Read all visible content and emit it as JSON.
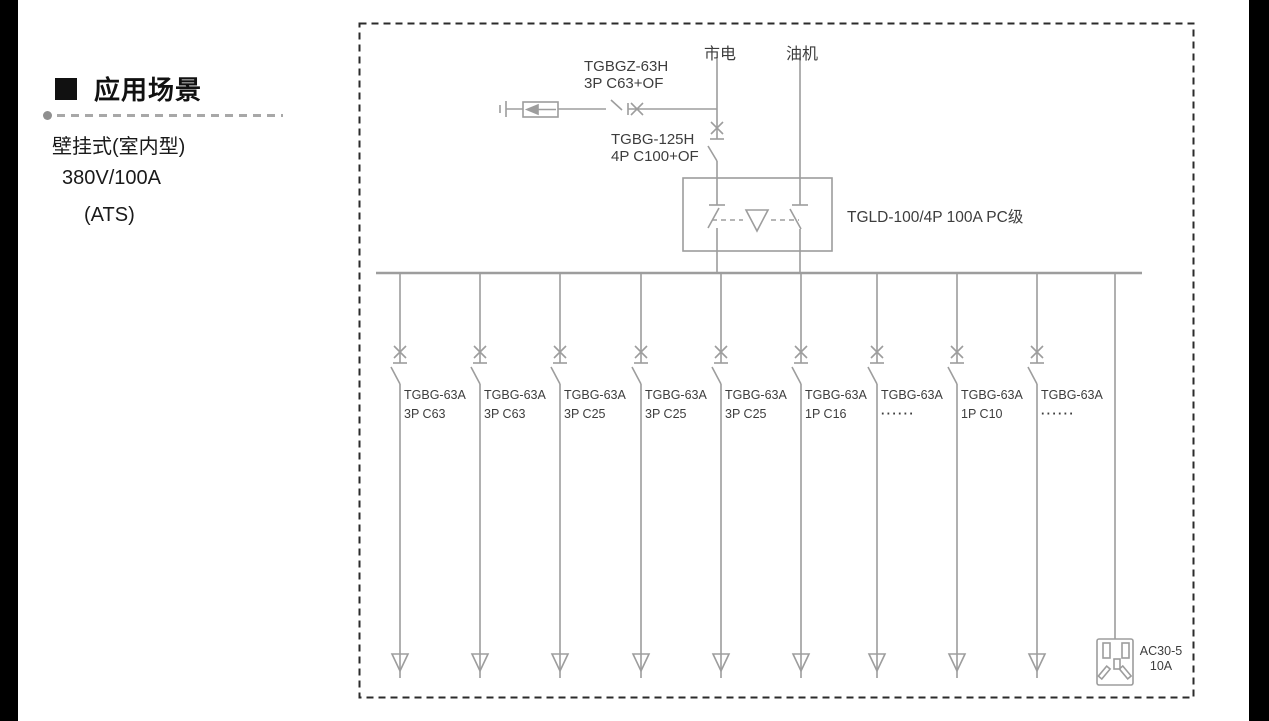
{
  "left_panel": {
    "heading": "应用场景",
    "specs": [
      "壁挂式(室内型)",
      "380V/100A",
      "(ATS)"
    ]
  },
  "diagram": {
    "sources": {
      "mains": "市电",
      "generator": "油机"
    },
    "spd_breaker": {
      "line1": "TGBGZ-63H",
      "line2": "3P C63+OF"
    },
    "main_breaker": {
      "line1": "TGBG-125H",
      "line2": "4P C100+OF"
    },
    "ats": {
      "label": "TGLD-100/4P 100A PC级"
    },
    "branches": [
      {
        "line1": "TGBG-63A",
        "line2": "3P C63"
      },
      {
        "line1": "TGBG-63A",
        "line2": "3P C63"
      },
      {
        "line1": "TGBG-63A",
        "line2": "3P C25"
      },
      {
        "line1": "TGBG-63A",
        "line2": "3P C25"
      },
      {
        "line1": "TGBG-63A",
        "line2": "3P C25"
      },
      {
        "line1": "TGBG-63A",
        "line2": "1P C16"
      },
      {
        "line1": "TGBG-63A",
        "line2": "······"
      },
      {
        "line1": "TGBG-63A",
        "line2": "1P C10"
      },
      {
        "line1": "TGBG-63A",
        "line2": "······"
      }
    ],
    "socket": {
      "line1": "AC30-5",
      "line2": "10A"
    }
  },
  "colors": {
    "schematic_line": "#9d9d9d",
    "schematic_text": "#3d3d3d",
    "heading_text": "#111111",
    "border_dash": "#2b2b2b"
  }
}
